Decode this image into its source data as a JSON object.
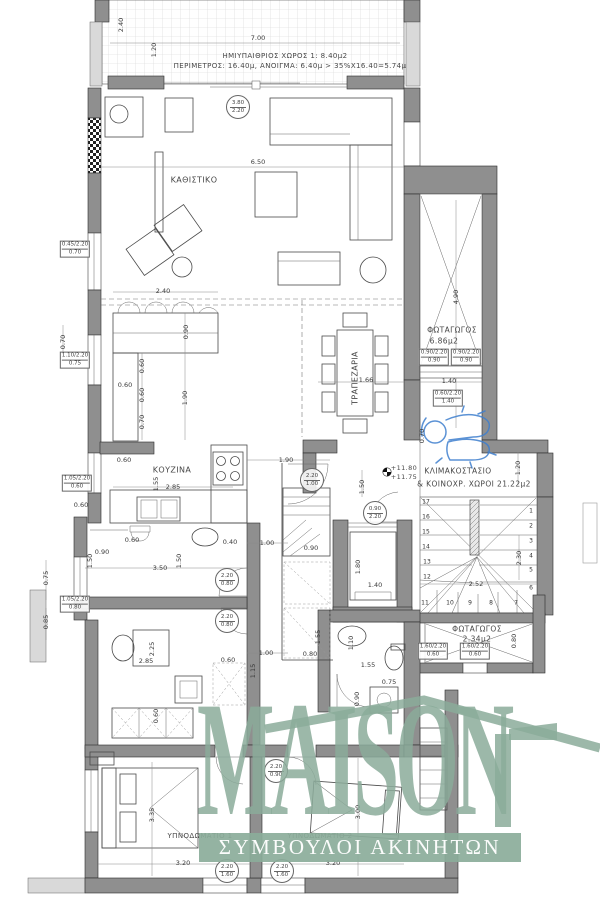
{
  "watermark": {
    "brand": "MAISON",
    "tagline": "ΣΥΜΒΟΥΛΟΙ ΑΚΙΝΗΤΩΝ"
  },
  "colors": {
    "wall": "#8f8f8f",
    "wall_light": "#d9d9d9",
    "line": "#3f3f3f",
    "watermark_green": "#8bac9a",
    "figure_blue": "#3f7fce"
  },
  "room_labels": [
    [
      "ΗΜΙΥΠΑΙΘΡΙΟΣ ΧΩΡΟΣ 1: 8.40μ2",
      285,
      56,
      7,
      0
    ],
    [
      "ΠΕΡΙΜΕΤΡΟΣ: 16.40μ, ΑΝΟΙΓΜΑ: 6.40μ > 35%Χ16.40=5.74μ",
      290,
      66,
      7,
      0
    ],
    [
      "ΚΑΘΙΣΤΙΚΟ",
      194,
      180,
      8,
      0
    ],
    [
      "ΤΡΑΠΕΖΑΡΙΑ",
      355,
      378,
      8,
      1
    ],
    [
      "ΚΟΥΖΙΝΑ",
      172,
      470,
      8,
      0
    ],
    [
      "ΦΩΤΑΓΩΓΟΣ",
      452,
      330,
      7.5,
      0
    ],
    [
      "6.86μ2",
      444,
      341,
      7.5,
      0
    ],
    [
      "ΚΛΙΜΑΚΟΣΤΑΣΙΟ",
      458,
      471,
      7.5,
      0
    ],
    [
      "& ΚΟΙΝΟΧΡ. ΧΩΡΟΙ 21.22μ2",
      474,
      484,
      7.5,
      0
    ],
    [
      "+11.80",
      404,
      468,
      6.5,
      0
    ],
    [
      "+11.75",
      404,
      477,
      6.5,
      0
    ],
    [
      "ΦΩΤΑΓΩΓΟΣ",
      477,
      629,
      7.5,
      0
    ],
    [
      "2.34μ2",
      477,
      639,
      7.5,
      0
    ],
    [
      "ΥΠΝΟΔΩΜΑΤΙΟ 1",
      200,
      836,
      7,
      0
    ],
    [
      "ΥΠΝΟΔΩΜΑΤΙΟ 2",
      320,
      836,
      7,
      0
    ]
  ],
  "dimensions": [
    [
      "7.00",
      258,
      38,
      0
    ],
    [
      "2.40",
      121,
      25,
      1
    ],
    [
      "1.20",
      154,
      50,
      1
    ],
    [
      "6.50",
      258,
      162,
      0
    ],
    [
      "2.40",
      163,
      291,
      0
    ],
    [
      "0.90",
      186,
      332,
      1
    ],
    [
      "0.60",
      142,
      366,
      1
    ],
    [
      "0.60",
      125,
      385,
      0
    ],
    [
      "0.60",
      142,
      395,
      1
    ],
    [
      "1.90",
      185,
      398,
      1
    ],
    [
      "0.70",
      142,
      422,
      1
    ],
    [
      "0.60",
      124,
      460,
      0
    ],
    [
      "2.85",
      173,
      487,
      0
    ],
    [
      "1.55",
      156,
      484,
      1
    ],
    [
      "1.90",
      286,
      460,
      0
    ],
    [
      "0.70",
      63,
      342,
      1
    ],
    [
      "0.75",
      46,
      578,
      1
    ],
    [
      "0.85",
      46,
      622,
      1
    ],
    [
      "0.60",
      81,
      505,
      0
    ],
    [
      "0.90",
      102,
      552,
      0
    ],
    [
      "1.50",
      90,
      561,
      1
    ],
    [
      "3.50",
      160,
      568,
      0
    ],
    [
      "1.50",
      179,
      561,
      1
    ],
    [
      "0.60",
      132,
      540,
      0
    ],
    [
      "0.40",
      230,
      542,
      0
    ],
    [
      "0.90",
      311,
      548,
      0
    ],
    [
      "1.00",
      267,
      543,
      0
    ],
    [
      "1.00",
      266,
      653,
      0
    ],
    [
      "0.80",
      310,
      654,
      0
    ],
    [
      "1.55",
      318,
      637,
      1
    ],
    [
      "2.85",
      146,
      661,
      0
    ],
    [
      "2.25",
      152,
      649,
      1
    ],
    [
      "0.60",
      228,
      660,
      0
    ],
    [
      "1.15",
      253,
      671,
      1
    ],
    [
      "0.60",
      156,
      716,
      1
    ],
    [
      "3.35",
      152,
      815,
      1
    ],
    [
      "3.20",
      183,
      863,
      0
    ],
    [
      "3.20",
      333,
      863,
      0
    ],
    [
      "3.00",
      358,
      812,
      1
    ],
    [
      "1.10",
      351,
      643,
      1
    ],
    [
      "1.55",
      368,
      665,
      0
    ],
    [
      "0.75",
      389,
      682,
      0
    ],
    [
      "0.90",
      357,
      699,
      1
    ],
    [
      "1.66",
      366,
      380,
      0
    ],
    [
      "1.40",
      449,
      381,
      0
    ],
    [
      "4.90",
      456,
      297,
      1
    ],
    [
      "0.70",
      422,
      436,
      1
    ],
    [
      "1.50",
      362,
      487,
      1
    ],
    [
      "1.20",
      518,
      468,
      1
    ],
    [
      "2.30",
      519,
      558,
      1
    ],
    [
      "2.52",
      476,
      584,
      0
    ],
    [
      "1.80",
      358,
      567,
      1
    ],
    [
      "1.40",
      375,
      585,
      0
    ],
    [
      "0.80",
      514,
      641,
      1
    ]
  ],
  "box_tags": [
    [
      "0.45/2.20",
      "0.70",
      75,
      249
    ],
    [
      "1.10/2.20",
      "0.75",
      75,
      360
    ],
    [
      "1.05/2.20",
      "0.60",
      77,
      483
    ],
    [
      "1.05/2.20",
      "0.80",
      75,
      604
    ],
    [
      "0.90/2.20",
      "0.90",
      434,
      357
    ],
    [
      "0.90/2.20",
      "0.90",
      466,
      357
    ],
    [
      "0.60/2.20",
      "1.40",
      448,
      398
    ],
    [
      "1.60/2.20",
      "0.60",
      433,
      651
    ],
    [
      "1.60/2.20",
      "0.60",
      475,
      651
    ]
  ],
  "circle_tags": [
    [
      "3.80",
      "2.20",
      238,
      107
    ],
    [
      "2.20",
      "1.00",
      312,
      480
    ],
    [
      "0.90",
      "2.20",
      375,
      513
    ],
    [
      "2.20",
      "0.80",
      227,
      580
    ],
    [
      "2.20",
      "0.80",
      227,
      621
    ],
    [
      "2.20",
      "0.90",
      276,
      771
    ],
    [
      "2.20",
      "1.60",
      227,
      871
    ],
    [
      "2.20",
      "1.60",
      282,
      871
    ]
  ],
  "stair_numbers": [
    [
      "17",
      426,
      502
    ],
    [
      "16",
      426,
      517
    ],
    [
      "15",
      426,
      532
    ],
    [
      "14",
      426,
      547
    ],
    [
      "13",
      427,
      562
    ],
    [
      "12",
      427,
      577
    ],
    [
      "11",
      425,
      603
    ],
    [
      "10",
      450,
      603
    ],
    [
      "9",
      470,
      603
    ],
    [
      "8",
      491,
      603
    ],
    [
      "7",
      516,
      603
    ],
    [
      "1",
      531,
      511
    ],
    [
      "2",
      531,
      526
    ],
    [
      "3",
      531,
      541
    ],
    [
      "4",
      531,
      556
    ],
    [
      "5",
      531,
      570
    ],
    [
      "6",
      531,
      588
    ]
  ]
}
